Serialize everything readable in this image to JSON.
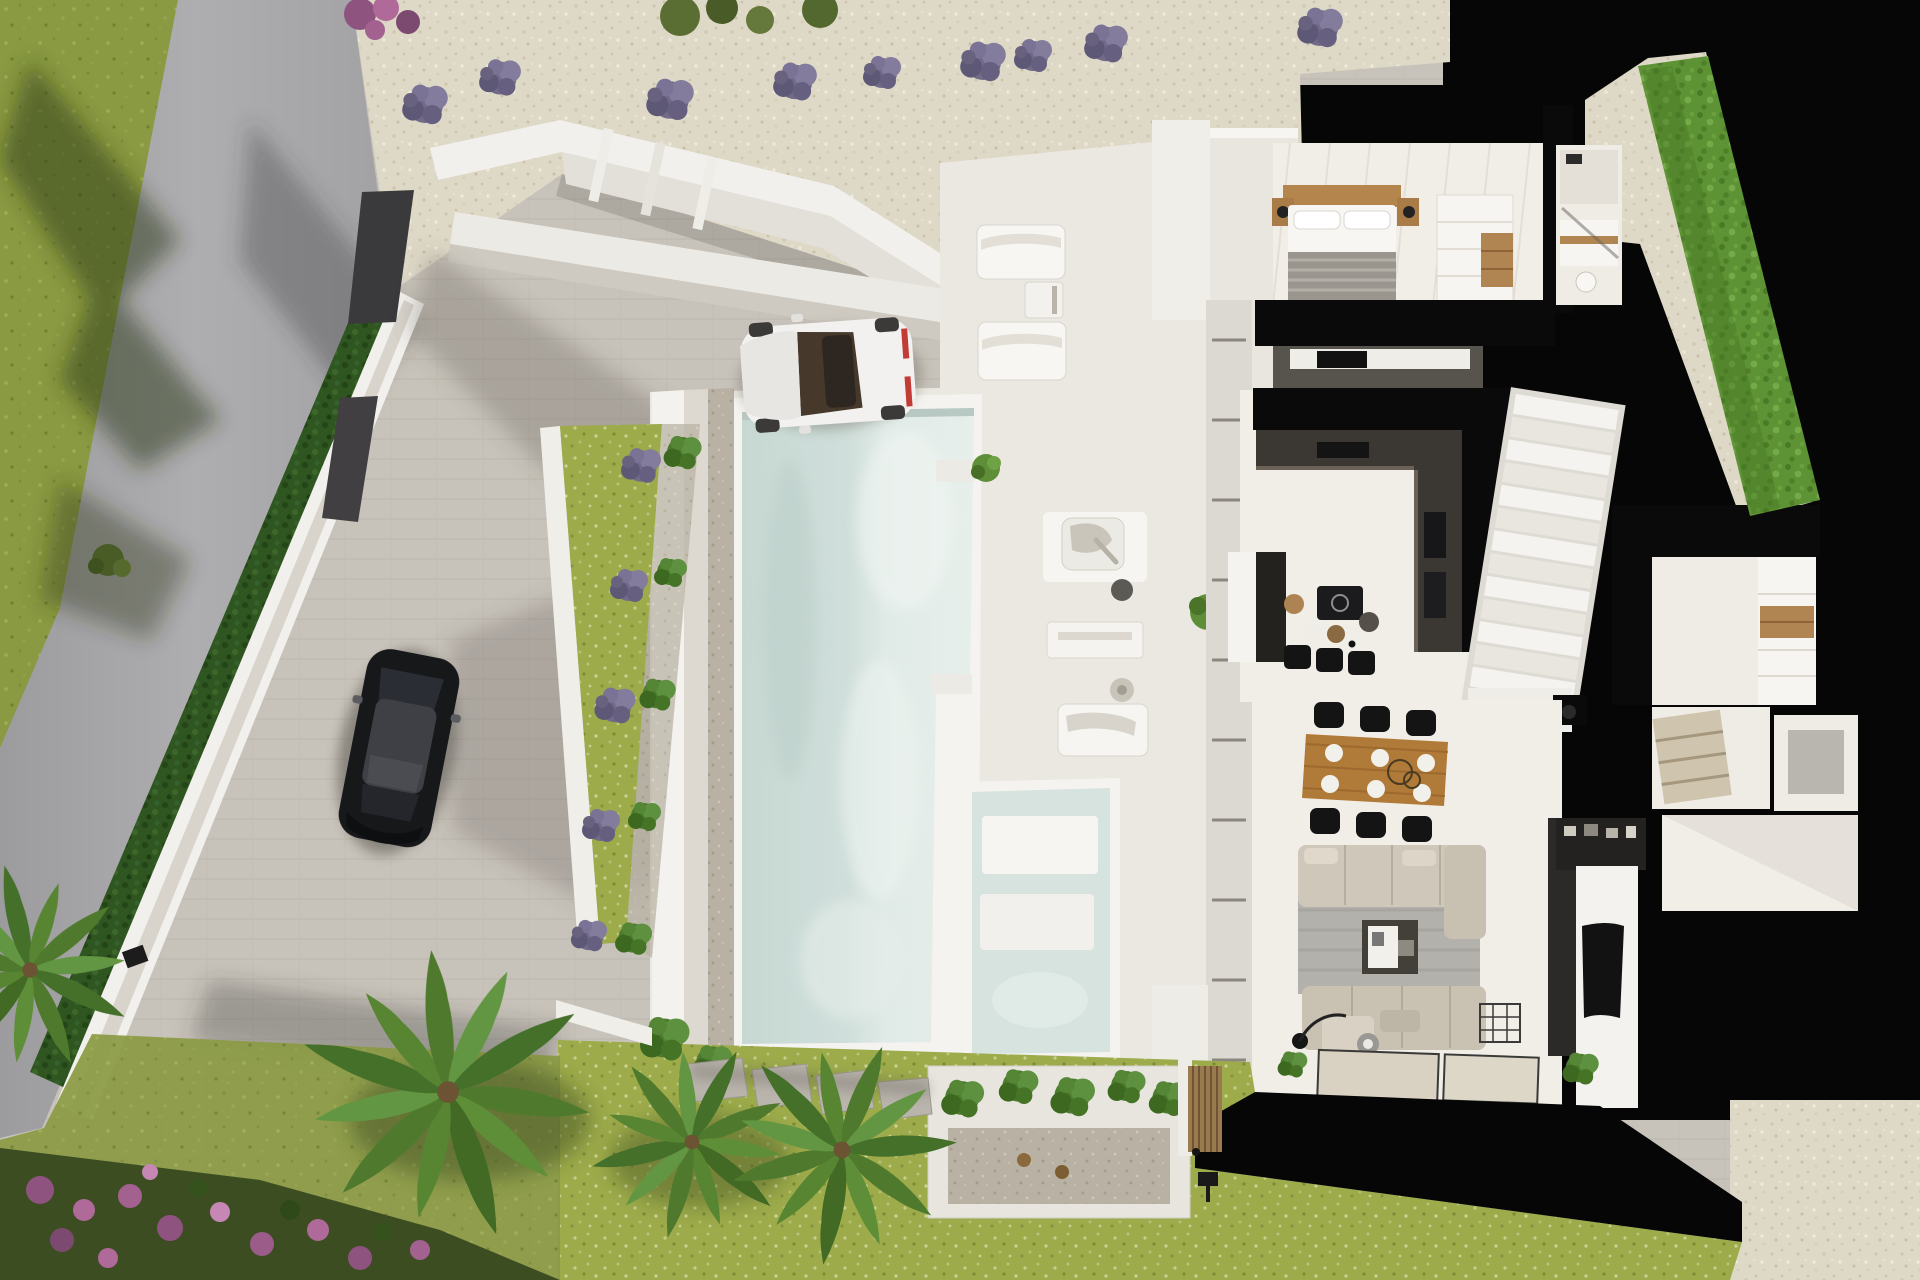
{
  "scene": {
    "type": "aerial-3d-architectural-render",
    "description": "Top-down 3D dollhouse rendering of a modern white villa: cutaway interior with bedroom, bathroom, kitchen, staircase, dining and living rooms on the right; swimming pool, spa, sun terrace, gravel driveway with a white sports car and a black car, lavender-lined gravel bank, perimeter wall with hedgerow, palm trees and flower beds on the left and bottom.",
    "counts": {
      "cars": 2,
      "sun_loungers": 2,
      "dining_chairs": 6,
      "bar_stools": 3,
      "palm_trees": 3,
      "lavender_bushes_top": 9,
      "pools": 2
    }
  },
  "colors": {
    "black": "#060606",
    "gravel": "#ded8c7",
    "road": "#a7a6a9",
    "pavers": "#c8c3ba",
    "lawnTop": "#8a9a42",
    "lawnBottom": "#9dab4b",
    "lawnDark": "#76853b",
    "hedgeDark": "#2f5520",
    "hedgeBright": "#5d9334",
    "wallWhite": "#f2f0ec",
    "deckWhite": "#ebe8e2",
    "poolRim": "#f4f3ef",
    "waterLeft": "#c9dad5",
    "waterRight": "#e3ece8",
    "charcoal": "#35342f",
    "woodHead": "#b5854e",
    "woodTable": "#b07a38",
    "sofa": "#cfc7b9",
    "rug": "#b3b1ac",
    "floor": "#f1eee8",
    "carWhite": "#f2f1ef",
    "carBlack": "#17181a",
    "lavender": "#716b88",
    "shrub": "#4d7c2e",
    "flowerPink": "#ad6f9f"
  }
}
